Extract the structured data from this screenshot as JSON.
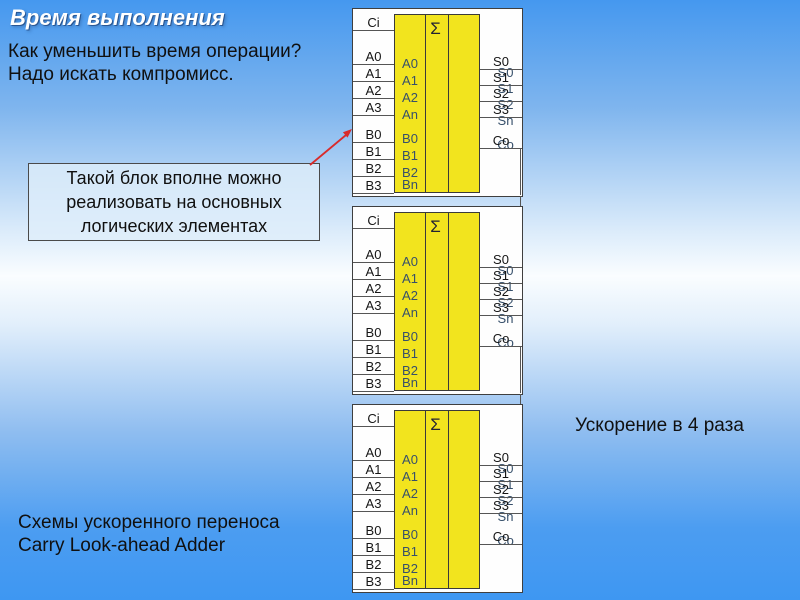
{
  "slide": {
    "title": "Время выполнения",
    "intro": [
      "Как уменьшить время операции?",
      "Надо искать компромисс."
    ],
    "callout": [
      "Такой блок вполне можно",
      "реализовать на основных",
      "логических элементах"
    ],
    "right_note": "Ускорение в 4 раза",
    "footer": [
      "Схемы ускоренного переноса",
      "Carry Look-ahead Adder"
    ]
  },
  "diagram": {
    "block_count": 3,
    "sigma": "Σ",
    "pins_left": {
      "ci": "Ci",
      "a": [
        "A0",
        "A1",
        "A2",
        "A3"
      ],
      "b": [
        "B0",
        "B1",
        "B2",
        "B3"
      ]
    },
    "pins_right": {
      "s": [
        "S0",
        "S1",
        "S2",
        "S3"
      ],
      "co": "Co"
    },
    "inner": {
      "a": [
        "A0",
        "A1",
        "A2",
        "An"
      ],
      "b": [
        "B0",
        "B1",
        "B2",
        "Bn"
      ],
      "s": [
        "S0",
        "S1",
        "S2",
        "Sn"
      ],
      "co": "Co"
    }
  },
  "colors": {
    "block_fill": "#F2E41E",
    "arrow": "#D92B2B",
    "title_text": "#FFFFFF",
    "inner_label": "#37506B",
    "background_top": "#4598EF",
    "background_mid": "#FAFDFF",
    "background_bottom": "#3E97F2"
  }
}
